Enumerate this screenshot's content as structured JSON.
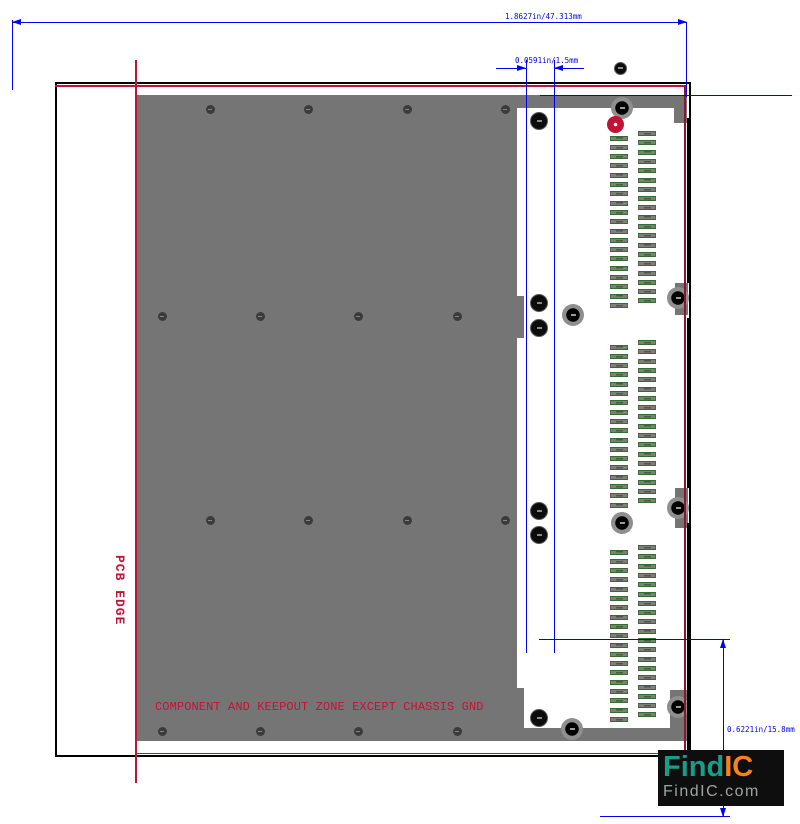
{
  "colors": {
    "dim_blue": "#0000ee",
    "red_line": "#c41236",
    "red_line_dark": "#8e1430",
    "body_gray": "#757575",
    "pad_green": "#2f6f2f",
    "logo_teal": "#1a9c8a",
    "logo_orange": "#f58220"
  },
  "dims": {
    "top": "1.8627in/47.313mm",
    "pitch": "0.0591in/1.5mm",
    "right": "0.6221in/15.8mm"
  },
  "labels": {
    "pcb_edge": "PCB EDGE",
    "keepout": "COMPONENT AND KEEPOUT ZONE EXCEPT CHASSIS GND"
  },
  "logo": {
    "find": "Find",
    "ic": "IC",
    "domain": "FindIC.com"
  },
  "drawing": {
    "rects": [
      {
        "x": 137,
        "y": 95,
        "w": 380,
        "h": 646,
        "name": "component-body"
      },
      {
        "x": 517,
        "y": 95,
        "w": 170,
        "h": 13,
        "name": "top-flange"
      },
      {
        "x": 674,
        "y": 108,
        "w": 13,
        "h": 15,
        "name": "top-right-tab"
      },
      {
        "x": 517,
        "y": 728,
        "w": 170,
        "h": 13,
        "name": "bottom-flange"
      },
      {
        "x": 670,
        "y": 690,
        "w": 17,
        "h": 38,
        "name": "bottom-right-tab"
      },
      {
        "x": 675,
        "y": 283,
        "w": 13,
        "h": 32,
        "name": "right-tab-upper"
      },
      {
        "x": 675,
        "y": 488,
        "w": 13,
        "h": 40,
        "name": "right-tab-lower"
      },
      {
        "x": 517,
        "y": 296,
        "w": 7,
        "h": 42,
        "name": "body-tab-upper"
      },
      {
        "x": 517,
        "y": 688,
        "w": 7,
        "h": 40,
        "name": "body-tab-lower"
      }
    ],
    "black_segments": [
      {
        "x": 687,
        "y": 118,
        "w": 4,
        "h": 165
      },
      {
        "x": 687,
        "y": 318,
        "w": 4,
        "h": 170
      },
      {
        "x": 687,
        "y": 523,
        "w": 4,
        "h": 230
      }
    ],
    "red_lines": [
      {
        "x": 135,
        "y": 60,
        "w": 1.5,
        "h": 723
      },
      {
        "x": 55,
        "y": 85,
        "w": 631,
        "h": 1.5
      },
      {
        "x": 684,
        "y": 85,
        "w": 1.5,
        "h": 669,
        "c": "#8e1430"
      },
      {
        "x": 135,
        "y": 752.5,
        "w": 551,
        "h": 1.5
      }
    ],
    "blue_lines": [
      {
        "x": 12,
        "y": 22,
        "w": 674,
        "h": 1
      },
      {
        "x": 12,
        "y": 20,
        "w": 1,
        "h": 70
      },
      {
        "x": 686,
        "y": 22,
        "w": 1,
        "h": 75
      },
      {
        "x": 540,
        "y": 95,
        "w": 252,
        "h": 1
      },
      {
        "x": 496,
        "y": 68,
        "w": 30,
        "h": 1
      },
      {
        "x": 554,
        "y": 68,
        "w": 30,
        "h": 1
      },
      {
        "x": 526,
        "y": 60,
        "w": 1,
        "h": 593
      },
      {
        "x": 554,
        "y": 60,
        "w": 1,
        "h": 593
      },
      {
        "x": 539,
        "y": 639,
        "w": 191,
        "h": 1
      },
      {
        "x": 600,
        "y": 816,
        "w": 130,
        "h": 1
      },
      {
        "x": 723,
        "y": 639,
        "w": 1,
        "h": 178
      }
    ],
    "arrows": [
      {
        "x": 12,
        "y": 22.5,
        "dir": "left"
      },
      {
        "x": 687,
        "y": 22.5,
        "dir": "right"
      },
      {
        "x": 526,
        "y": 68.5,
        "dir": "right"
      },
      {
        "x": 554,
        "y": 68.5,
        "dir": "left"
      },
      {
        "x": 723.5,
        "y": 639,
        "dir": "up"
      },
      {
        "x": 723.5,
        "y": 817,
        "dir": "down"
      }
    ],
    "body_holes": [
      [
        210,
        109
      ],
      [
        308,
        109
      ],
      [
        407,
        109
      ],
      [
        505,
        109
      ],
      [
        162,
        316
      ],
      [
        260,
        316
      ],
      [
        358,
        316
      ],
      [
        457,
        316
      ],
      [
        210,
        520
      ],
      [
        308,
        520
      ],
      [
        407,
        520
      ],
      [
        505,
        520
      ],
      [
        162,
        731
      ],
      [
        260,
        731
      ],
      [
        358,
        731
      ],
      [
        457,
        731
      ]
    ],
    "big_holes": [
      [
        539,
        121,
        18
      ],
      [
        539,
        303,
        18
      ],
      [
        539,
        328,
        18
      ],
      [
        539,
        511,
        18
      ],
      [
        539,
        535,
        18
      ],
      [
        539,
        718,
        18
      ],
      [
        620,
        68,
        13
      ]
    ],
    "ring_holes": [
      [
        622,
        108
      ],
      [
        573,
        315
      ],
      [
        622,
        523
      ],
      [
        572,
        729
      ],
      [
        678,
        298
      ],
      [
        678,
        508
      ],
      [
        678,
        707
      ]
    ],
    "red_hole": [
      615,
      124
    ],
    "pads": {
      "left_x": 610,
      "right_x": 638,
      "pitch": 9.3,
      "blocks": [
        {
          "right_y": 131,
          "left_y": 135.5,
          "count": 19
        },
        {
          "right_y": 340,
          "left_y": 344.5,
          "count": 18
        },
        {
          "right_y": 545,
          "left_y": 549.5,
          "count": 19
        }
      ]
    }
  }
}
